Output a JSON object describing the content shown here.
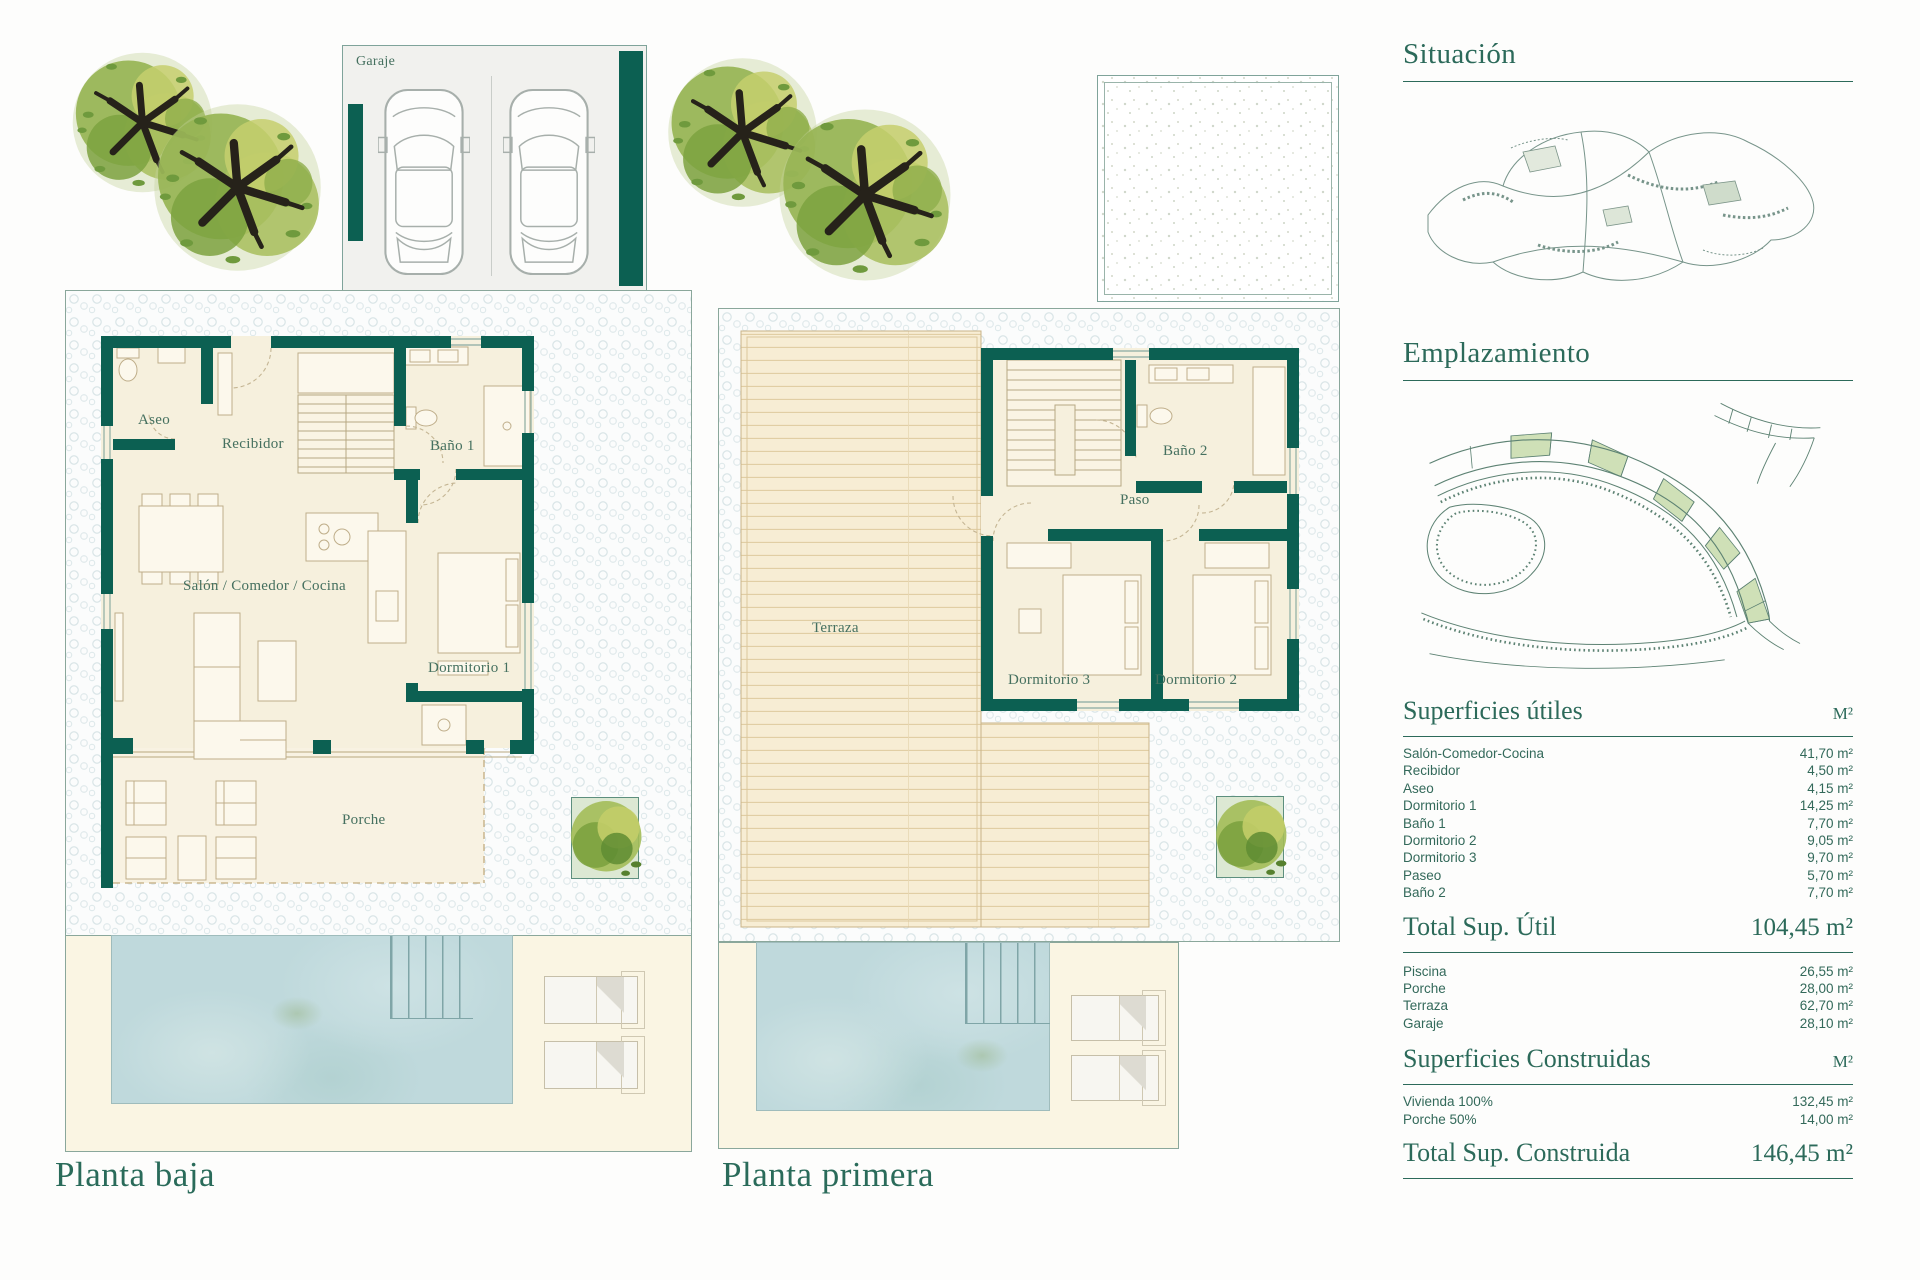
{
  "colors": {
    "wall_teal": "#0c6052",
    "heading_teal": "#2c6a5a",
    "plot_border": "#8aa79b",
    "floor_beige": "#f6f0dd",
    "deck_tan": "#f7edd4",
    "pool_blue": "#bfd9dc",
    "lot_green": "#cfe0b7"
  },
  "ground_floor": {
    "title": "Planta baja",
    "garage_label": "Garaje",
    "rooms": {
      "aseo": "Aseo",
      "recibidor": "Recibidor",
      "bano1": "Baño 1",
      "salon": "Salón / Comedor / Cocina",
      "dormitorio1": "Dormitorio 1",
      "porche": "Porche"
    }
  },
  "first_floor": {
    "title": "Planta primera",
    "rooms": {
      "terraza": "Terraza",
      "bano2": "Baño 2",
      "paso": "Paso",
      "dormitorio3": "Dormitorio 3",
      "dormitorio2": "Dormitorio 2"
    }
  },
  "panel": {
    "situacion_title": "Situación",
    "emplazamiento_title": "Emplazamiento",
    "useful": {
      "title": "Superficies útiles",
      "unit": "M²",
      "rows": [
        {
          "label": "Salón-Comedor-Cocina",
          "value": "41,70 m²"
        },
        {
          "label": "Recibidor",
          "value": "4,50 m²"
        },
        {
          "label": "Aseo",
          "value": "4,15 m²"
        },
        {
          "label": "Dormitorio 1",
          "value": "14,25 m²"
        },
        {
          "label": "Baño 1",
          "value": "7,70 m²"
        },
        {
          "label": "Dormitorio 2",
          "value": "9,05 m²"
        },
        {
          "label": "Dormitorio 3",
          "value": "9,70 m²"
        },
        {
          "label": "Paseo",
          "value": "5,70 m²"
        },
        {
          "label": "Baño 2",
          "value": "7,70 m²"
        }
      ],
      "total_label": "Total Sup. Útil",
      "total_value": "104,45 m²"
    },
    "outdoor_rows": [
      {
        "label": "Piscina",
        "value": "26,55 m²"
      },
      {
        "label": "Porche",
        "value": "28,00 m²"
      },
      {
        "label": "Terraza",
        "value": "62,70 m²"
      },
      {
        "label": "Garaje",
        "value": "28,10 m²"
      }
    ],
    "built": {
      "title": "Superficies Construidas",
      "unit": "M²",
      "rows": [
        {
          "label": "Vivienda 100%",
          "value": "132,45 m²"
        },
        {
          "label": "Porche 50%",
          "value": "14,00 m²"
        }
      ],
      "total_label": "Total Sup. Construida",
      "total_value": "146,45 m²"
    }
  }
}
